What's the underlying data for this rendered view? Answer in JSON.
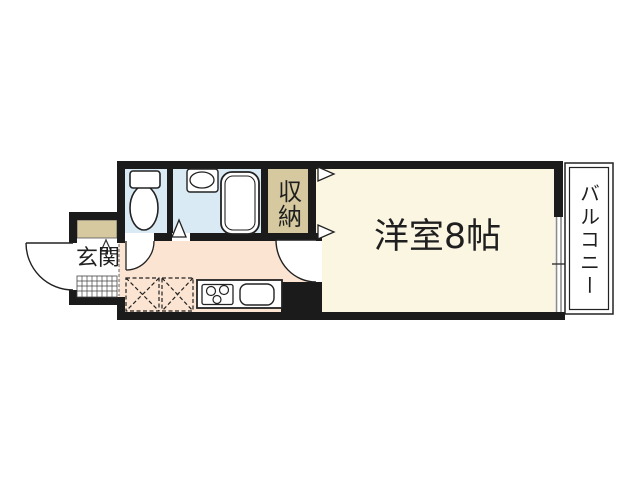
{
  "plan": {
    "type": "apartment-floor-plan",
    "labels": {
      "main_room": "洋室8帖",
      "entrance": "玄関",
      "storage": "収納",
      "balcony": "バルコニー"
    },
    "colors": {
      "wall": "#1b1b1b",
      "water_rooms": "#d9eaf5",
      "kitchen_hall": "#fbe4d2",
      "main_room": "#faf6e2",
      "storage_tan": "#d6c9a0",
      "white": "#ffffff",
      "window_gray": "#8c8c8c",
      "line": "#222222",
      "text": "#1f1f1f"
    },
    "symbols": [
      "toilet",
      "wash-basin",
      "bathtub",
      "folding-door-triangle",
      "closet-door-arrows",
      "shoe-cabinet",
      "entry-tile-hatch",
      "entry-step-marker",
      "door-swing-arc-entrance",
      "door-swing-arc-toilet",
      "door-swing-arc-main-room",
      "appliance-space-dashed",
      "appliance-space-dashed",
      "gas-stove-3-burner",
      "kitchen-sink",
      "sliding-window",
      "balcony-deck"
    ]
  }
}
